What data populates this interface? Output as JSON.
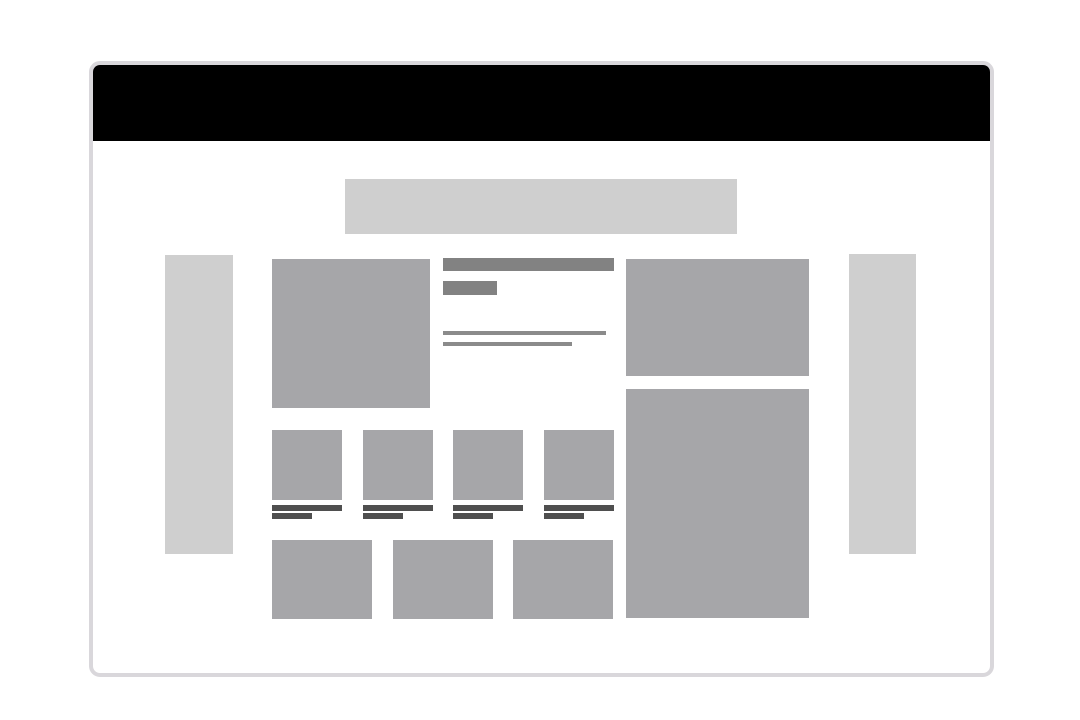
{
  "canvas": {
    "background": "#ffffff"
  },
  "window": {
    "background": "#ffffff",
    "border_color": "#d9d7db",
    "header_bar_color": "#000000"
  },
  "placeholders": {
    "light_block_color": "#cfcfcf",
    "medium_block_color": "#a6a6a9",
    "dark_bar_color": "#828282",
    "text_line_color": "#8b8b8b",
    "caption_line_color": "#4f4f4f"
  },
  "content": {
    "thumbnail_count": 4,
    "bottom_block_count": 3
  }
}
